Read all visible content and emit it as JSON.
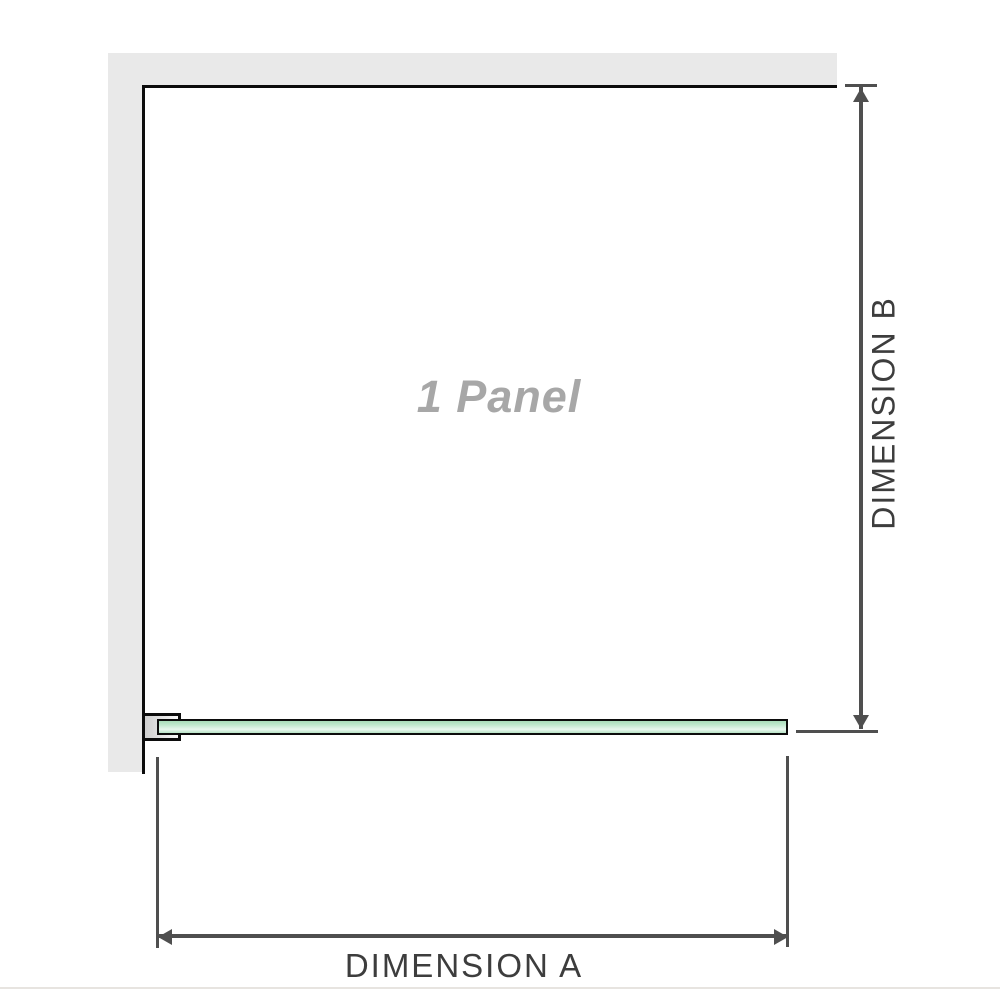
{
  "diagram": {
    "panel_label": "1 Panel",
    "dimensions": {
      "a_label": "DIMENSION A",
      "b_label": "DIMENSION B"
    },
    "colors": {
      "wall": "#e9e9e9",
      "outline": "#0c0c0c",
      "glass_top": "#a9ddb9",
      "glass_mid": "#c3e9d0",
      "glass_light": "#e9f7ef",
      "glass_bottom": "#b7e3c5",
      "bracket_fill_dark": "#cfcfcf",
      "bracket_fill_light": "#f8f8f8",
      "dimension_line": "#4f4f4f",
      "dimension_text": "#3d3d3d",
      "panel_text": "#a7a7a7",
      "baseline": "#e7e4e0"
    }
  }
}
